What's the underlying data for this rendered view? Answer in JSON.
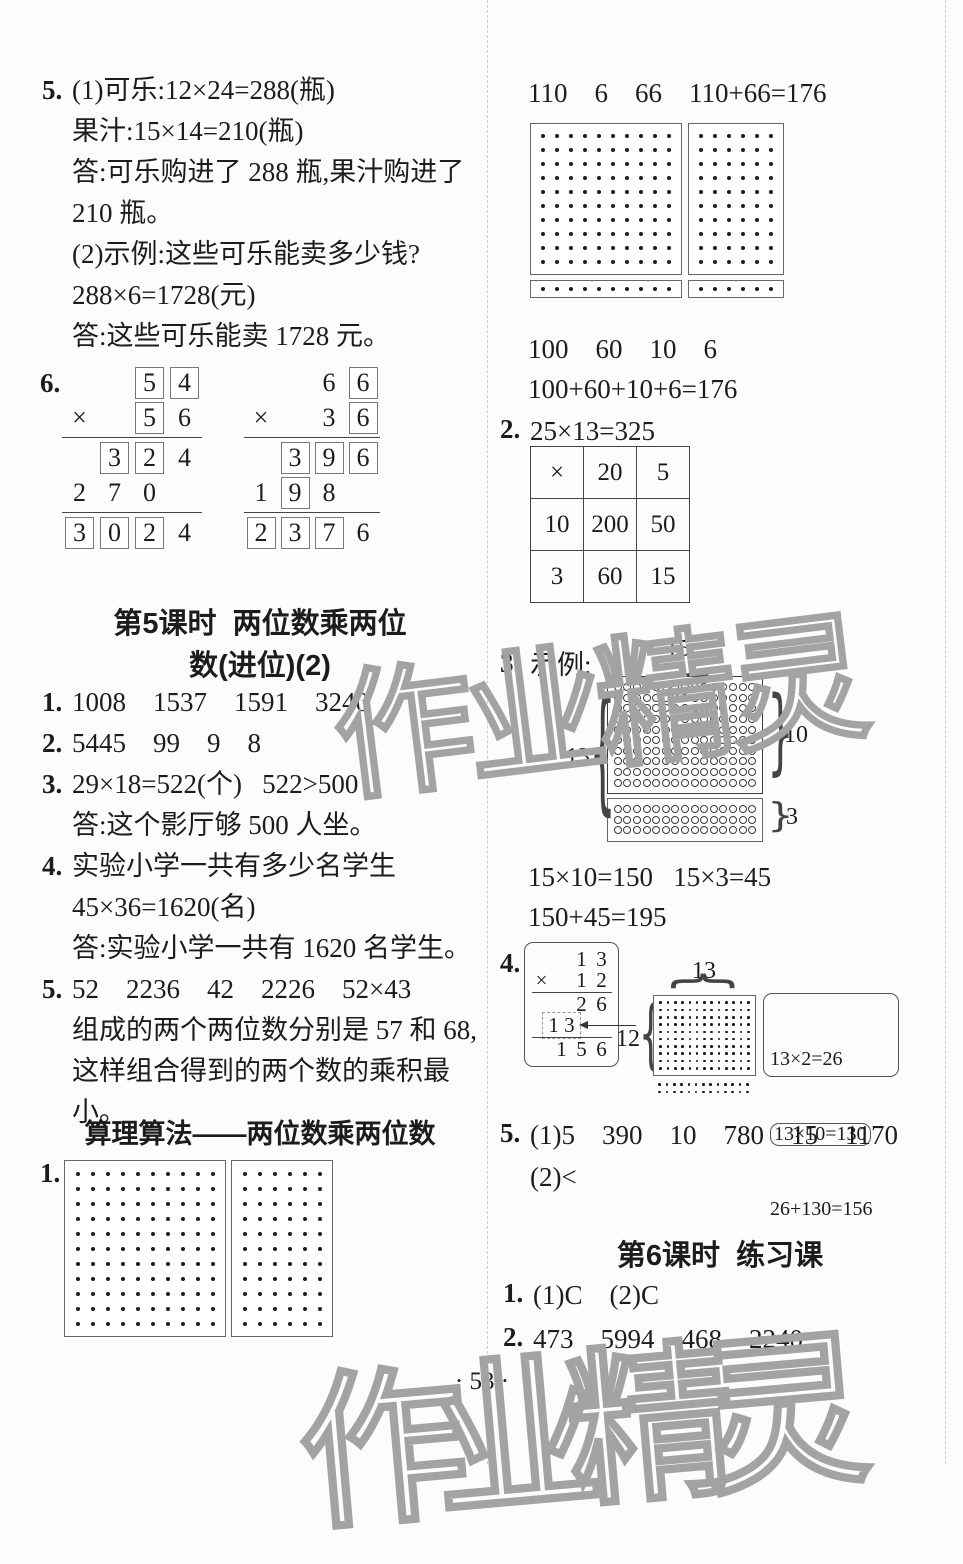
{
  "page": {
    "number_label": "· 53 ·",
    "paper_color": "#fcfcfc",
    "ink_color": "#1c1c1c",
    "watermark_color": "#a3a3a3"
  },
  "watermark": {
    "text": "作业精灵"
  },
  "left": {
    "p5": {
      "lines": [
        {
          "num": "5.",
          "text": "(1)可乐:12×24=288(瓶)"
        },
        {
          "text": "果汁:15×14=210(瓶)"
        },
        {
          "text": "答:可乐购进了 288 瓶,果汁购进了"
        },
        {
          "text": "210 瓶。"
        },
        {
          "text": "(2)示例:这些可乐能卖多少钱?"
        },
        {
          "text": "288×6=1728(元)"
        },
        {
          "text": "答:这些可乐能卖 1728 元。"
        }
      ]
    },
    "p6": {
      "num": "6.",
      "mults": [
        {
          "rows": [
            [
              null,
              null,
              {
                "d": "5",
                "b": 1
              },
              {
                "d": "4",
                "b": 1
              }
            ],
            [
              {
                "d": "×"
              },
              null,
              {
                "d": "5",
                "b": 1
              },
              {
                "d": "6"
              }
            ],
            "hr",
            [
              null,
              {
                "d": "3",
                "b": 1
              },
              {
                "d": "2",
                "b": 1
              },
              {
                "d": "4"
              }
            ],
            [
              {
                "d": "2"
              },
              {
                "d": "7"
              },
              {
                "d": "0"
              },
              null
            ],
            "hr",
            [
              {
                "d": "3",
                "b": 1
              },
              {
                "d": "0",
                "b": 1
              },
              {
                "d": "2",
                "b": 1
              },
              {
                "d": "4"
              }
            ]
          ]
        },
        {
          "rows": [
            [
              null,
              null,
              {
                "d": "6"
              },
              {
                "d": "6",
                "b": 1
              }
            ],
            [
              {
                "d": "×"
              },
              null,
              {
                "d": "3"
              },
              {
                "d": "6",
                "b": 1
              }
            ],
            "hr",
            [
              null,
              {
                "d": "3",
                "b": 1
              },
              {
                "d": "9",
                "b": 1
              },
              {
                "d": "6",
                "b": 1
              }
            ],
            [
              {
                "d": "1"
              },
              {
                "d": "9",
                "b": 1
              },
              {
                "d": "8"
              },
              null
            ],
            "hr",
            [
              {
                "d": "2",
                "b": 1
              },
              {
                "d": "3",
                "b": 1
              },
              {
                "d": "7",
                "b": 1
              },
              {
                "d": "6"
              }
            ]
          ]
        }
      ]
    },
    "sec5": {
      "line1": "第5课时  两位数乘两位",
      "line2": "数(进位)(2)"
    },
    "answers5": {
      "lines": [
        {
          "num": "1.",
          "text": "1008    1537    1591    3240"
        },
        {
          "num": "2.",
          "text": "5445    99    9    8"
        },
        {
          "num": "3.",
          "text": "29×18=522(个)   522>500"
        },
        {
          "text": "答:这个影厅够 500 人坐。"
        },
        {
          "num": "4.",
          "text": "实验小学一共有多少名学生"
        },
        {
          "text": "45×36=1620(名)"
        },
        {
          "text": "答:实验小学一共有 1620 名学生。"
        },
        {
          "num": "5.",
          "text": "52    2236    42    2226    52×43"
        },
        {
          "text": "组成的两个两位数分别是 57 和 68,"
        },
        {
          "text": "这样组合得到的两个数的乘积最小。"
        }
      ]
    },
    "sec_suanli": {
      "title": "算理算法——两位数乘两位数"
    },
    "p1": {
      "num": "1.",
      "grids": [
        {
          "cols": 10,
          "rows": 11
        },
        {
          "cols": 6,
          "rows": 11
        }
      ]
    }
  },
  "right": {
    "r1": "110    6    66    110+66=176",
    "grids": {
      "boxes": [
        {
          "cols": 10,
          "rows": 10
        },
        {
          "cols": 6,
          "rows": 10
        }
      ],
      "strips": [
        {
          "cols": 10,
          "rows": 1
        },
        {
          "cols": 6,
          "rows": 1
        }
      ]
    },
    "r2": "100    60    10    6",
    "r3": "100+60+10+6=176",
    "p2": {
      "num": "2.",
      "text": "25×13=325",
      "table": [
        [
          "×",
          "20",
          "5"
        ],
        [
          "10",
          "200",
          "50"
        ],
        [
          "3",
          "60",
          "15"
        ]
      ]
    },
    "p3": {
      "num": "3.",
      "label": "示例:",
      "grid_top": {
        "cols": 15,
        "rows": 10
      },
      "grid_bottom": {
        "cols": 15,
        "rows": 3
      },
      "labels": {
        "top": "15",
        "left": "13",
        "right_top": "10",
        "right_bottom": "3"
      },
      "eq1": "15×10=150   15×3=45",
      "eq2": "150+45=195"
    },
    "p4": {
      "num": "4.",
      "mult": {
        "rows": [
          [
            null,
            null,
            {
              "d": "1"
            },
            {
              "d": "3"
            }
          ],
          [
            {
              "d": "×"
            },
            null,
            {
              "d": "1"
            },
            {
              "d": "2"
            }
          ],
          "hr",
          [
            null,
            null,
            {
              "d": "2"
            },
            {
              "d": "6"
            }
          ],
          [
            null,
            {
              "d": "1 3",
              "span": 2,
              "dash": 1
            },
            null
          ],
          "hr",
          [
            null,
            {
              "d": "1"
            },
            {
              "d": "5"
            },
            {
              "d": "6"
            }
          ]
        ]
      },
      "grid_boxed": {
        "cols": 13,
        "rows": 10
      },
      "grid_below": {
        "cols": 13,
        "rows": 2
      },
      "labels": {
        "top": "13",
        "left": "12"
      },
      "equations": {
        "line1": "13×2=26",
        "line2": "13×10=130",
        "line3": "26+130=156"
      }
    },
    "p5": {
      "num": "5.",
      "line1": "(1)5    390    10    780    15    1170",
      "line2": "(2)<"
    },
    "sec6": {
      "title": "第6课时  练习课"
    },
    "answers6": {
      "l1_num": "1.",
      "l1": "(1)C    (2)C",
      "l2_num": "2.",
      "l2": "473    5994    468    2240"
    }
  }
}
